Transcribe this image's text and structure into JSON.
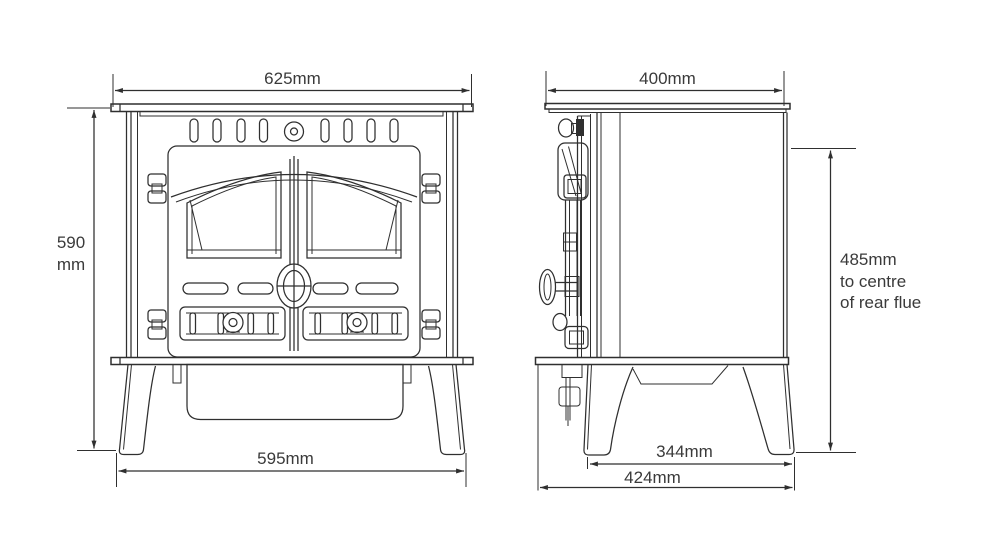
{
  "labels": {
    "front_width_top": "625mm",
    "front_height": [
      "590",
      "mm"
    ],
    "front_width_base": "595mm",
    "side_depth_top": "400mm",
    "side_flue_height": [
      "485mm",
      "to centre",
      "of rear flue"
    ],
    "side_base_between_legs": "344mm",
    "side_base_overall": "424mm"
  },
  "colors": {
    "line": "#2f2f2f",
    "text": "#3a3a3a",
    "background": "#ffffff"
  }
}
